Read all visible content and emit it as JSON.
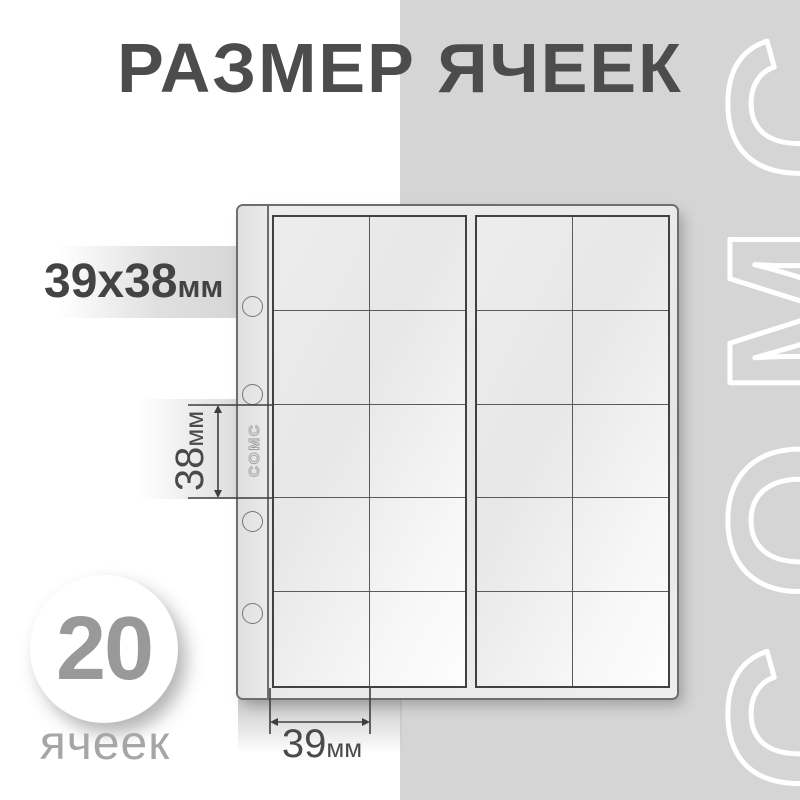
{
  "title": "РАЗМЕР ЯЧЕЕК",
  "dimensions": {
    "cell": {
      "value": "39х38",
      "unit": "мм"
    },
    "height": {
      "value": "38",
      "unit": "мм"
    },
    "width": {
      "value": "39",
      "unit": "мм"
    }
  },
  "badge": {
    "count": "20",
    "label": "ячеек"
  },
  "sheet": {
    "brand": "COMC",
    "rows": 5,
    "blocks": 2,
    "columns_per_block": 2,
    "total_cells": 20,
    "binder_holes": 4
  },
  "watermark": {
    "text": "COMC"
  },
  "colors": {
    "panel": "#d5d5d5",
    "title": "#4c4c4c",
    "badge_number": "#999999",
    "badge_label": "#a6a6a6",
    "watermark_outline": "#ffffff",
    "dimension": "#4a4a4a"
  }
}
